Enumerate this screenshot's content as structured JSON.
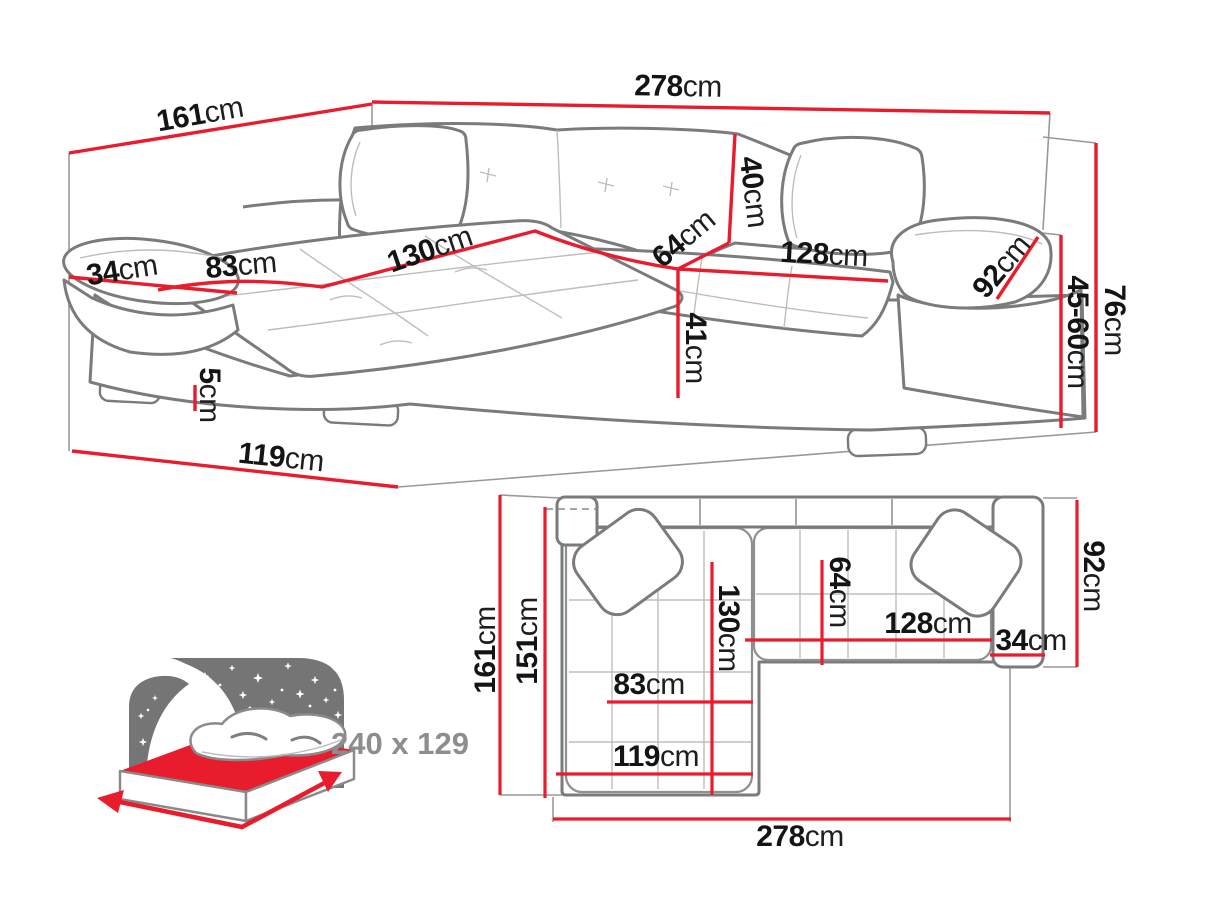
{
  "window": {
    "title": "Corner sofa bed dimensions diagram"
  },
  "colors": {
    "dimension_red": "#e81c2c",
    "outline_gray": "#7b7b7b",
    "seam_gray": "#bdbdbd",
    "aux_gray": "#999999",
    "text_black": "#141414",
    "muted_gray_text": "#8d8d8d",
    "star_panel_gray": "#757575",
    "background": "#ffffff"
  },
  "perspective_view": {
    "name": "corner sofa perspective view",
    "labels": [
      {
        "id": "depth-161",
        "value": "161",
        "unit": "cm",
        "x": 200,
        "y": 115,
        "rot": -10
      },
      {
        "id": "width-278",
        "value": "278",
        "unit": "cm",
        "x": 678,
        "y": 87,
        "rot": 1
      },
      {
        "id": "armrest-width-34",
        "value": "34",
        "unit": "cm",
        "x": 122,
        "y": 271,
        "rot": -9
      },
      {
        "id": "chaise-width-83",
        "value": "83",
        "unit": "cm",
        "x": 241,
        "y": 266,
        "rot": -5
      },
      {
        "id": "chaise-length-130",
        "value": "130",
        "unit": "cm",
        "x": 430,
        "y": 250,
        "rot": -19
      },
      {
        "id": "seat-depth-64",
        "value": "64",
        "unit": "cm",
        "x": 684,
        "y": 239,
        "rot": -40
      },
      {
        "id": "backrest-height-40",
        "value": "40",
        "unit": "cm",
        "x": 753,
        "y": 192,
        "rot": 83
      },
      {
        "id": "seat-length-128",
        "value": "128",
        "unit": "cm",
        "x": 824,
        "y": 255,
        "rot": 3
      },
      {
        "id": "armrest-length-92",
        "value": "92",
        "unit": "cm",
        "x": 1002,
        "y": 267,
        "rot": -50
      },
      {
        "id": "seat-height-41",
        "value": "41",
        "unit": "cm",
        "x": 695,
        "y": 348,
        "rot": 90
      },
      {
        "id": "leg-height-5",
        "value": "5",
        "unit": "cm",
        "x": 209,
        "y": 395,
        "rot": 90
      },
      {
        "id": "base-length-119",
        "value": "119",
        "unit": "cm",
        "x": 281,
        "y": 458,
        "rot": 6
      },
      {
        "id": "armrest-height-45-60",
        "value": "45-60",
        "unit": "cm",
        "x": 1077,
        "y": 332,
        "rot": 90
      },
      {
        "id": "total-height-76",
        "value": "76",
        "unit": "cm",
        "x": 1114,
        "y": 320,
        "rot": 90
      }
    ]
  },
  "plan_view": {
    "name": "corner sofa top-down plan view",
    "labels": [
      {
        "id": "plan-depth-161",
        "value": "161",
        "unit": "cm",
        "x": 486,
        "y": 650,
        "rot": -90
      },
      {
        "id": "plan-chaise-151",
        "value": "151",
        "unit": "cm",
        "x": 528,
        "y": 641,
        "rot": -90
      },
      {
        "id": "plan-chaise-130",
        "value": "130",
        "unit": "cm",
        "x": 728,
        "y": 628,
        "rot": 90
      },
      {
        "id": "plan-seat-64",
        "value": "64",
        "unit": "cm",
        "x": 839,
        "y": 592,
        "rot": 90
      },
      {
        "id": "plan-seat-128",
        "value": "128",
        "unit": "cm",
        "x": 928,
        "y": 624,
        "rot": 0
      },
      {
        "id": "plan-armrest-34",
        "value": "34",
        "unit": "cm",
        "x": 1031,
        "y": 641,
        "rot": 0
      },
      {
        "id": "plan-width-92",
        "value": "92",
        "unit": "cm",
        "x": 1093,
        "y": 576,
        "rot": 90
      },
      {
        "id": "plan-chaise-83",
        "value": "83",
        "unit": "cm",
        "x": 649,
        "y": 685,
        "rot": 0
      },
      {
        "id": "plan-base-119",
        "value": "119",
        "unit": "cm",
        "x": 656,
        "y": 757,
        "rot": 0
      },
      {
        "id": "plan-width-278",
        "value": "278",
        "unit": "cm",
        "x": 800,
        "y": 837,
        "rot": 0
      }
    ]
  },
  "bed_badge": {
    "icon": "sofa-bed-sleeping-area-icon",
    "label": "240 x 129"
  }
}
